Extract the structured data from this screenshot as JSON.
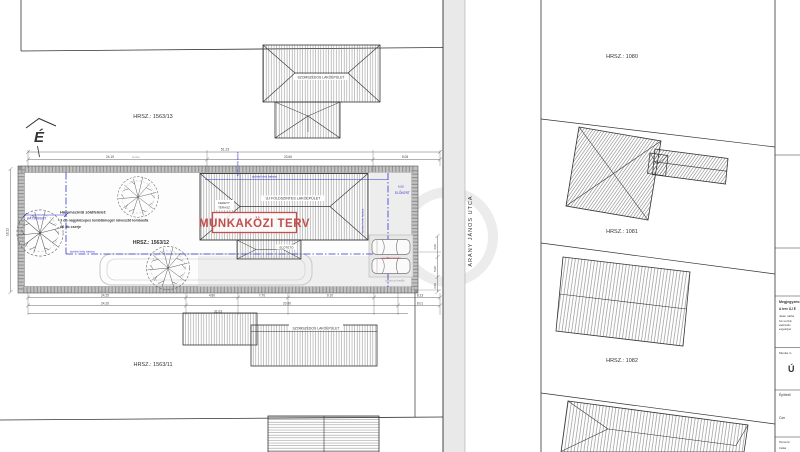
{
  "north": {
    "letter": "É"
  },
  "street": {
    "name": "ARANY JÁNOS UTCA"
  },
  "stamp": {
    "text": "MUNKAKÖZI TERV",
    "color": "#c0504d"
  },
  "parcels": {
    "p1563_13": "HRSZ.: 1563/13",
    "p1563_12": "HRSZ.: 1563/12",
    "p1563_11": "HRSZ.: 1563/11",
    "p1080": "HRSZ.: 1080",
    "p1081": "HRSZ.: 1081",
    "p1082": "HRSZ.: 1082"
  },
  "buildings": {
    "new_main": "ÚJ FÖLDSZINTES LAKÓÉPÜLET",
    "terrace_l1": "FEDETT",
    "terrace_l2": "TERASZ",
    "canopy": "ELŐTETŐ",
    "neighbor_top": "SZOMSZÉDOS LAKÓÉPÜLET",
    "neighbor_bottom": "SZOMSZÉDOS LAKÓÉPÜLET"
  },
  "green_note": {
    "title": "Háromszintű zöldfelület:",
    "line1": "- 3 db nagyközepes lombtömeget növesztő lombosfa",
    "line2": "- 60 db cserje"
  },
  "zoning": {
    "hatsokert": "HÁTSÓKERT",
    "elokert": "ELŐKERT",
    "front_depth": "6,00",
    "site_boundary_1": "építési hely határa",
    "site_boundary_2": "építési hely határa",
    "site_boundary_v1": "építési hely határa",
    "site_boundary_v2": "építési hely határa",
    "accent_color": "#3535cc"
  },
  "parking": {
    "label_red": "gépkocsi beálló",
    "label_gray": "gépkocsi beálló"
  },
  "dimensions": {
    "top_total": "51.23",
    "top_segments": [
      "24.15",
      "23.66",
      "8.08"
    ],
    "top_note": "kerítés",
    "bottom_row1": [
      "24.25",
      "4.80",
      "7.70",
      "9.10",
      "8.23"
    ],
    "bottom_row2": [
      "24.26",
      "20.80",
      "8.01"
    ],
    "bottom_row3": "31.03",
    "bottom_note": "kerítés",
    "left_height": "16.12",
    "right_side": [
      "4,00",
      "5,00",
      "3,50"
    ]
  },
  "titleblock": {
    "note_title": "Megjegyzés:",
    "note_line1": "A terv ÚJ É",
    "note_line2": "Jelen vázla",
    "note_small1": "Terv és Dok",
    "note_small2": "elektroniku",
    "note_small3": "engedélyez",
    "work_label": "Munka m",
    "work_big": "Ú",
    "client_label": "Építtető",
    "address_label": "Cím",
    "designer_label": "Tervező",
    "designer_small": "Csikai"
  }
}
